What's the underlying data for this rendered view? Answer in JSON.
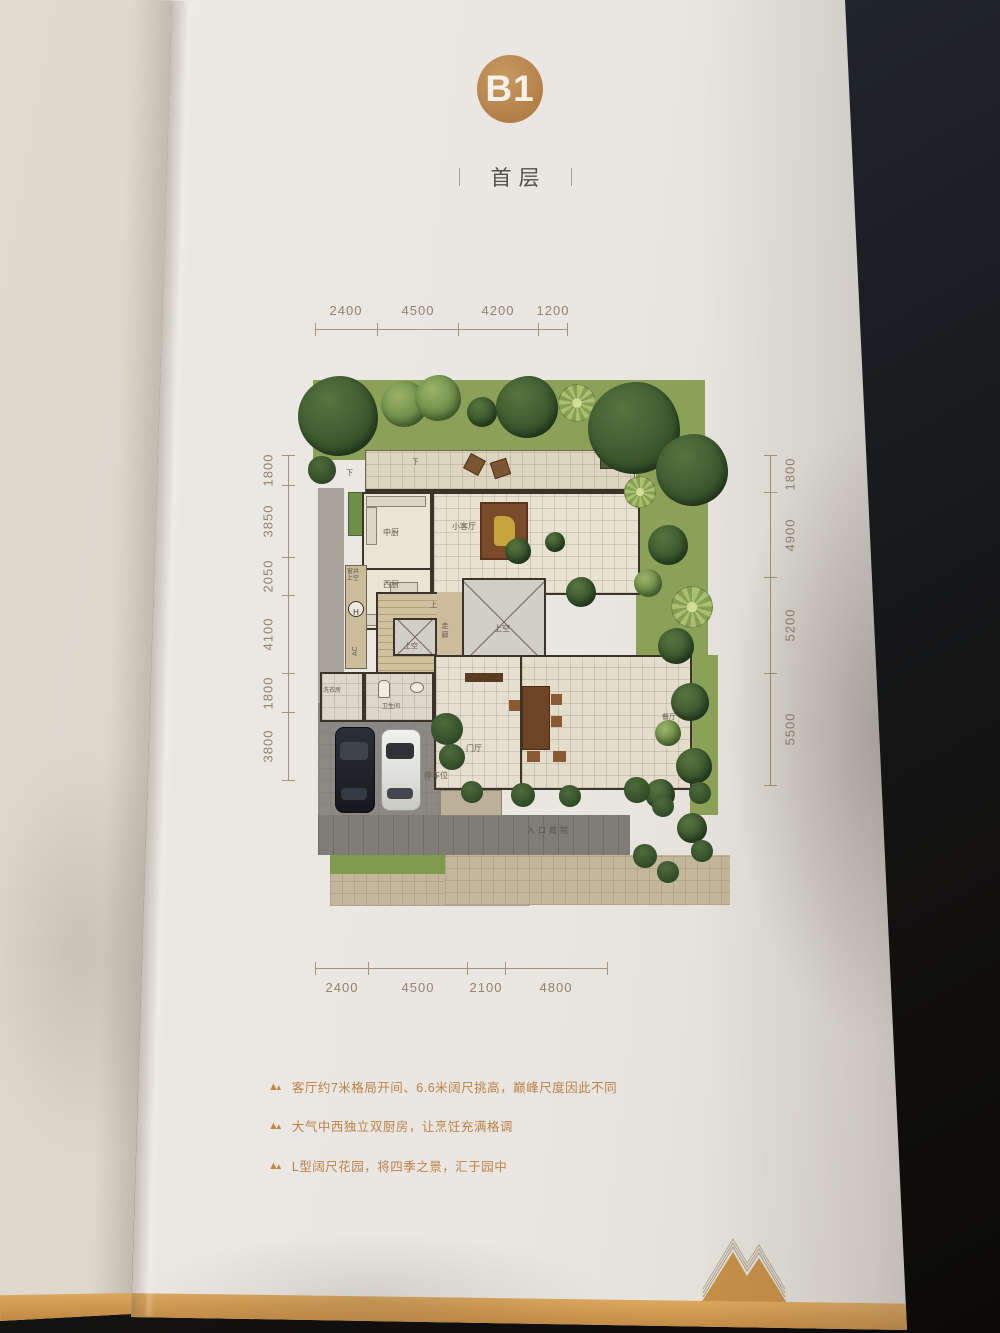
{
  "header": {
    "unit": "B1",
    "floor": "首层"
  },
  "dims": {
    "top": [
      "2400",
      "4500",
      "4200",
      "1200"
    ],
    "bottom": [
      "2400",
      "4500",
      "2100",
      "4800"
    ],
    "left": [
      "1800",
      "3850",
      "2050",
      "4100",
      "1800",
      "3800"
    ],
    "right": [
      "1800",
      "4900",
      "5200",
      "5500"
    ]
  },
  "plan": {
    "kitchen_cn": "中厨",
    "living_small": "小客厅",
    "kitchen_west": "西厨",
    "window_well": "窗井\n上空",
    "hoist": "H",
    "ac": "AC",
    "corridor": "走廊",
    "void": "上空",
    "up": "上",
    "down": "下",
    "laundry": "洗衣房",
    "bath": "卫生间",
    "foyer": "门厅",
    "dining": "餐厅",
    "parking": "停车位",
    "entry_court": "入口庭院"
  },
  "bullets": [
    "客厅约7米格局开间、6.6米阔尺挑高，巅峰尺度因此不同",
    "大气中西独立双厨房，让烹饪充满格调",
    "L型阔尺花园，将四季之景，汇于园中"
  ],
  "colors": {
    "gold": "#b9854e",
    "bullet_text": "#b9834a",
    "dim_text": "#93826e",
    "page": "#eae6e1"
  }
}
